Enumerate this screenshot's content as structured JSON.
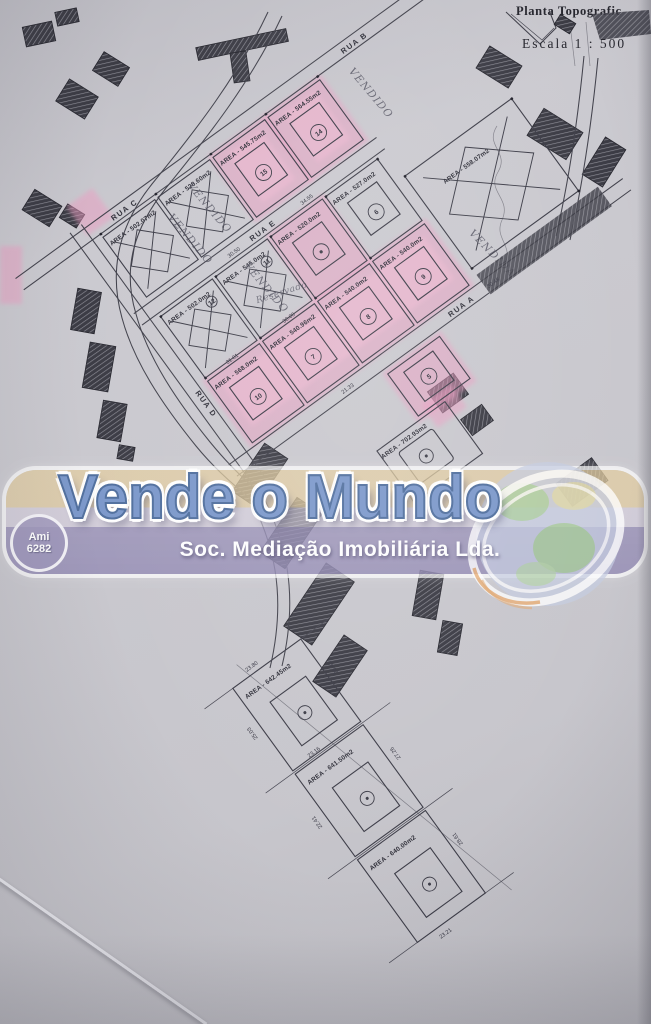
{
  "header": {
    "title": "Planta Topografic",
    "scale": "Escala 1 : 500"
  },
  "watermark": {
    "brand": "Vende o Mundo",
    "subtitle": "Soc. Mediação Imobiliária Lda.",
    "license1": "Ami",
    "license2": "6282"
  },
  "streets": {
    "a": "RUA A",
    "b": "RUA B",
    "c": "RUA C",
    "d": "RUA D",
    "e": "RUA E"
  },
  "notes": {
    "sold_m": "VENDIDO",
    "sold_f": "VENDIDA",
    "reserved": "Reservado"
  },
  "lots": {
    "s1": {
      "area": "AREA - 502.07m2",
      "status": "sold"
    },
    "s2": {
      "area": "AREA - 528.60m2",
      "status": "sold"
    },
    "s3": {
      "area": "AREA - 545.75m2",
      "number": "15",
      "status": "highlighted"
    },
    "s4": {
      "area": "AREA - 564.55m2",
      "number": "14",
      "status": "highlighted"
    },
    "b1": {
      "area": "AREA - 502.0m2",
      "number": "12",
      "status": "sold"
    },
    "b2": {
      "area": "AREA - 545.0m2",
      "number": "11",
      "status": "reserved"
    },
    "b3": {
      "area": "AREA - 520.0m2",
      "status": "highlighted"
    },
    "b4": {
      "area": "AREA - 527.0m2",
      "number": "6"
    },
    "c1": {
      "area": "AREA - 568.0m2",
      "number": "10",
      "status": "highlighted"
    },
    "c2": {
      "area": "AREA - 540.96m2",
      "number": "7",
      "status": "highlighted"
    },
    "c3": {
      "area": "AREA - 540.0m2",
      "number": "8",
      "status": "highlighted"
    },
    "c4": {
      "area": "AREA - 540.0m2",
      "number": "9",
      "status": "highlighted"
    },
    "c5": {
      "number": "5",
      "status": "highlighted"
    },
    "r1": {
      "area": "AREA - 558.07m2",
      "status": "sold"
    },
    "m1": {
      "area": "AREA - 702.93m2"
    },
    "d1": {
      "area": "AREA - 642.45m2"
    },
    "d2": {
      "area": "AREA - 641.50m2"
    },
    "d3": {
      "area": "AREA - 640.00m2"
    }
  },
  "dims": {
    "d1": "30.50",
    "d2": "34.55",
    "d3": "31.01",
    "d4": "30.00",
    "d5": "30.48",
    "d6": "21.33",
    "d7": "23.80",
    "d8": "25.03",
    "d9": "26.42",
    "d10": "23.16",
    "d11": "22.41",
    "d12": "27.26",
    "d13": "28.61",
    "d14": "23.21"
  },
  "colors": {
    "highlight_pink": "#ec9ec2",
    "paper_gray": "#c8c7cc",
    "ink": "#3d3d48",
    "brand_blue": "#7d99cb",
    "band_lavender": "#9b93b9",
    "band_tan": "#e3cea3"
  }
}
